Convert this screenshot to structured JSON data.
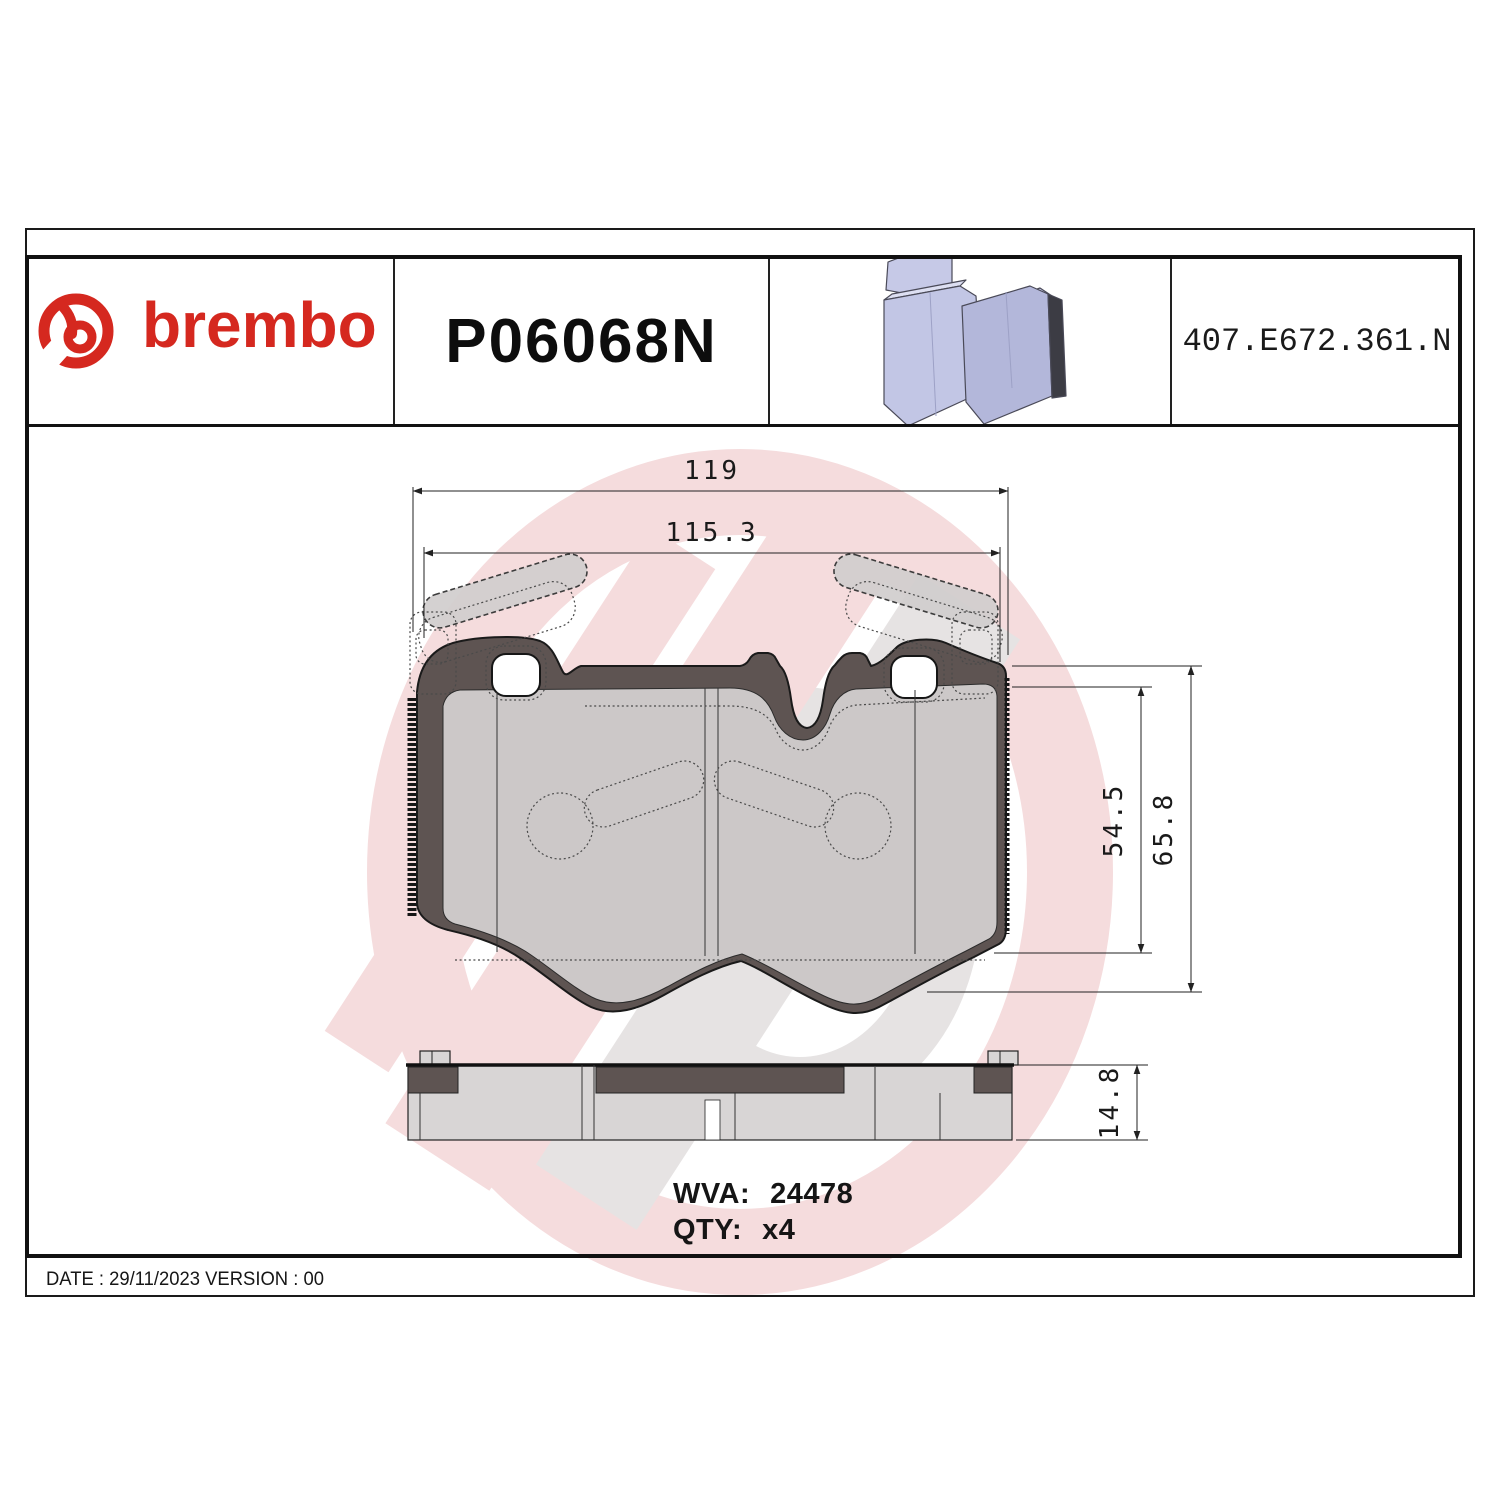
{
  "header": {
    "brand": {
      "wordmark": "brembo",
      "logo_icon": "brembo-ring-b-logo",
      "accent_color": "#d5281f"
    },
    "part_number": "P06068N",
    "catalog_code": "407.E672.361.N",
    "illustration": "brake-pad-3d-isometric"
  },
  "drawing": {
    "type": "brake-pad technical drawing, front view and side view with watermark",
    "dimensions": {
      "overall_width": "119",
      "pad_width": "115.3",
      "pad_height": "54.5",
      "overall_height": "65.8",
      "thickness": "14.8"
    },
    "wva_label": "WVA:",
    "wva_value": "24478",
    "qty_label": "QTY:",
    "qty_value": "x4"
  },
  "footer": {
    "text": "DATE : 29/11/2023 VERSION : 00"
  },
  "colors": {
    "brand_red": "#d5281f",
    "backing_plate": "#5e5452",
    "friction_pad": "#d6d3d3",
    "pad_3d_lavender": "#c4c8e6",
    "watermark_pink": "#f5dcdd",
    "watermark_gray": "#e6e3e3",
    "line": "#1a1a1a"
  }
}
